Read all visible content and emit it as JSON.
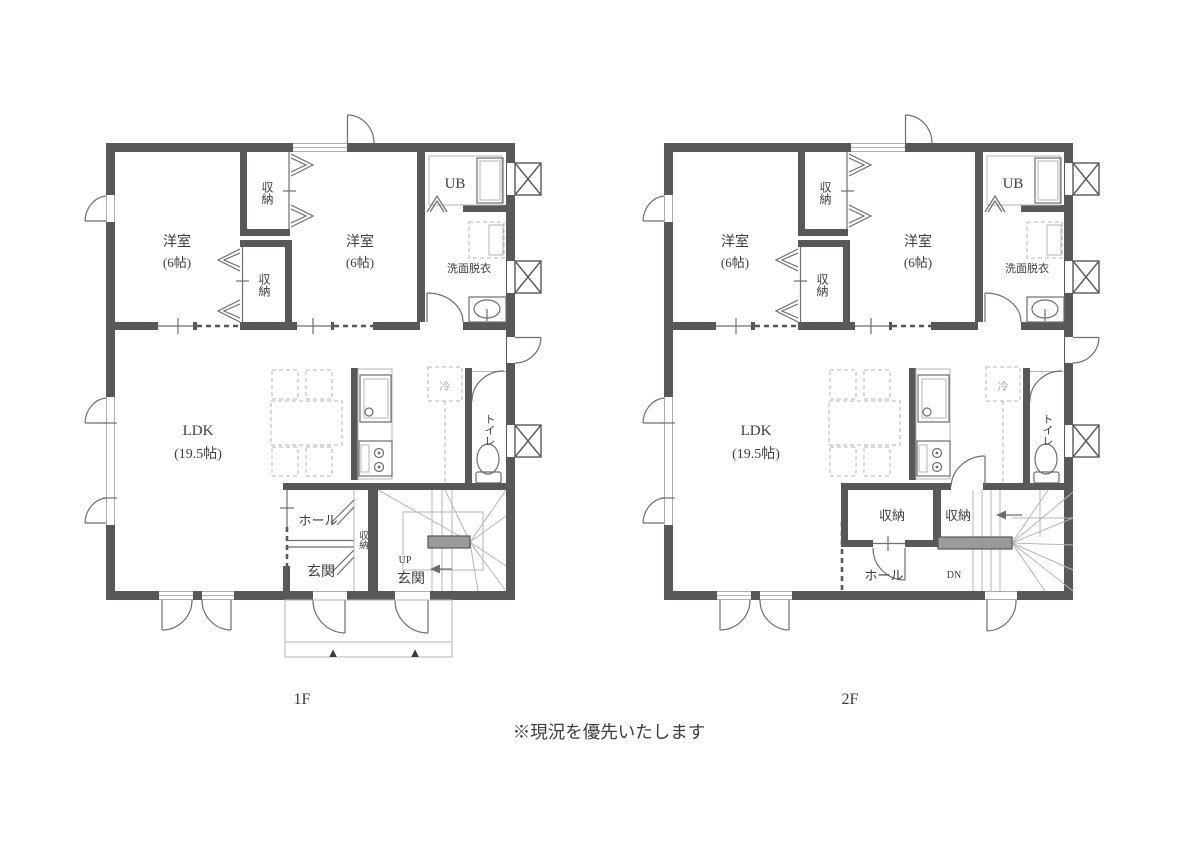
{
  "page": {
    "footnote": "※現況を優先いたします"
  },
  "colors": {
    "wall": "#595757",
    "line_medium": "#6f6d6d",
    "line_light": "#b7b5b5",
    "stair_landing_fill": "#9b9999",
    "text": "#3e3c3c",
    "text_light": "#b2b0b0",
    "background": "#ffffff"
  },
  "icons": {
    "entrance_step_marker": "▲"
  },
  "floor1": {
    "name": "1F",
    "bedroom_left": {
      "name": "洋室",
      "size": "(6帖)"
    },
    "bedroom_right": {
      "name": "洋室",
      "size": "(6帖)"
    },
    "closet_upper": "収納",
    "closet_lower": "収納",
    "unit_bath": "UB",
    "washroom": "洗面脱衣",
    "ldk": {
      "name": "LDK",
      "size": "(19.5帖)"
    },
    "refrigerator": "冷",
    "toilet": "トイレ",
    "hall": "ホール",
    "closet_hall": "収納",
    "entrance": "玄関",
    "entrance_stair_side": "玄関",
    "stair_direction": "UP"
  },
  "floor2": {
    "name": "2F",
    "bedroom_left": {
      "name": "洋室",
      "size": "(6帖)"
    },
    "bedroom_right": {
      "name": "洋室",
      "size": "(6帖)"
    },
    "closet_upper": "収納",
    "closet_lower": "収納",
    "unit_bath": "UB",
    "washroom": "洗面脱衣",
    "ldk": {
      "name": "LDK",
      "size": "(19.5帖)"
    },
    "refrigerator": "冷",
    "toilet": "トイレ",
    "closet_a": "収納",
    "closet_b": "収納",
    "hall": "ホール",
    "stair_direction": "DN"
  }
}
